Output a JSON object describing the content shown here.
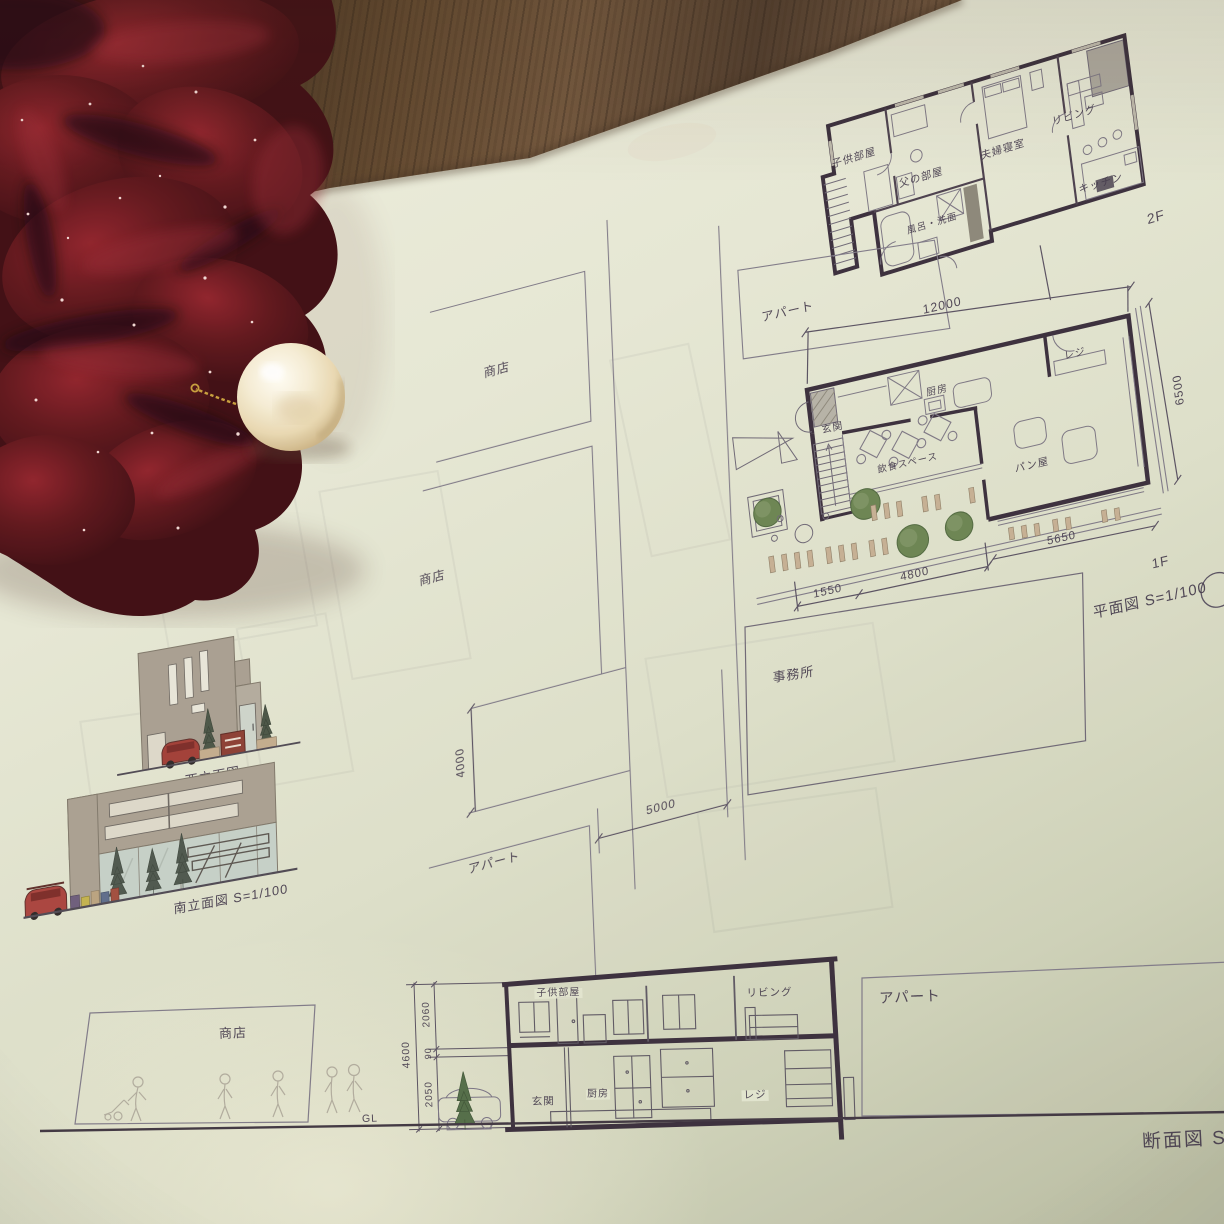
{
  "colors": {
    "paper": "#e3e6d1",
    "wood_dark": "#3c2b1e",
    "ink": "#3d3447",
    "wall": "#352a38",
    "thin_line": "#6b6573",
    "tree_green": "#68824f",
    "bench_tan": "#c4ae92",
    "facade_gray": "#a79e90",
    "glass": "#c6d1c9",
    "car_red": "#a03a33",
    "scrunchie_red": "#4a0b10",
    "pearl": "#f2e7c8",
    "gold": "#c9a23a"
  },
  "plan_2f": {
    "floor_label": "2F",
    "rooms": {
      "kids": "子供部屋",
      "father": "父の部屋",
      "bedroom": "夫婦寝室",
      "living": "リビング",
      "kitchen": "キッチン",
      "bath": "風呂・洗面"
    }
  },
  "plan_1f": {
    "floor_label": "1F",
    "caption": "平面図 S=1/100",
    "neighbor_top": "アパート",
    "office": "事務所",
    "rooms": {
      "entrance": "玄関",
      "kitchen": "厨房",
      "register": "レジ",
      "dining": "飲食スペース",
      "bakery": "パン屋"
    },
    "dims": {
      "width": "12000",
      "depth": "6500",
      "front": "5650",
      "mid": "4800",
      "left": "1550"
    }
  },
  "site": {
    "shop_upper": "商店",
    "shop_lower": "商店",
    "apartment": "アパート",
    "dims": {
      "v": "4000",
      "h": "5000"
    }
  },
  "elevations": {
    "west_caption": "西立面図",
    "south_caption": "南立面図 S=1/100"
  },
  "section": {
    "caption": "断面図 S=",
    "ground_label": "GL",
    "shop": "商店",
    "apartment": "アパート",
    "rooms": {
      "kids": "子供部屋",
      "living": "リビング",
      "entrance": "玄関",
      "kitchen": "厨房",
      "register": "レジ"
    },
    "dims": {
      "total": "4600",
      "upper": "2060",
      "slab": "90",
      "lower": "2050"
    }
  }
}
